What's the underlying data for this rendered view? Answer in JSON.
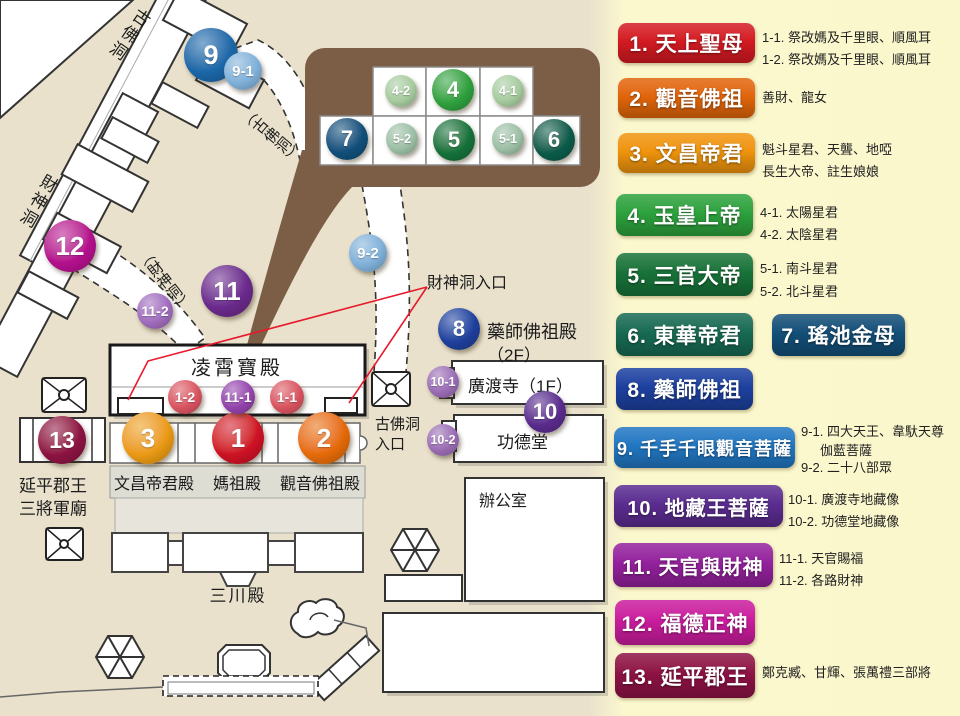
{
  "map": {
    "corridors": {
      "gufodong": "古佛洞",
      "caishendong": "財神洞",
      "gufodong_path": "（古佛洞）",
      "caishendong_path": "（財神洞）"
    },
    "buildings": {
      "lingxiao_hall": "凌霄寶殿",
      "wenchang_hall": "文昌帝君殿",
      "mazu_hall": "媽祖殿",
      "guanyin_hall": "觀音佛祖殿",
      "sanchuan_hall": "三川殿",
      "office": "辦公室",
      "guangdu_temple": "廣渡寺（1F）",
      "gongde_hall": "功德堂",
      "yaoshi_hall_line1": "藥師佛祖殿",
      "yaoshi_hall_line2": "（2F）",
      "yanping_line1": "延平郡王",
      "yanping_line2": "三將軍廟",
      "caishen_entrance": "財神洞入口",
      "gufo_entrance_line1": "古佛洞",
      "gufo_entrance_line2": "入口"
    },
    "markers": {
      "m1": {
        "label": "1",
        "color": "#cf1225"
      },
      "m1_1": {
        "label": "1-1",
        "color": "#d85360"
      },
      "m1_2": {
        "label": "1-2",
        "color": "#d85360"
      },
      "m2": {
        "label": "2",
        "color": "#e66b08"
      },
      "m3": {
        "label": "3",
        "color": "#eb9a14"
      },
      "m4": {
        "label": "4",
        "color": "#2ea03d"
      },
      "m4_1": {
        "label": "4-1",
        "color": "#a6cb9e"
      },
      "m4_2": {
        "label": "4-2",
        "color": "#a6cb9e"
      },
      "m5": {
        "label": "5",
        "color": "#15713a"
      },
      "m5_1": {
        "label": "5-1",
        "color": "#9cbfa5"
      },
      "m5_2": {
        "label": "5-2",
        "color": "#9cbfa5"
      },
      "m6": {
        "label": "6",
        "color": "#0b5b4a"
      },
      "m7": {
        "label": "7",
        "color": "#114f7a"
      },
      "m8": {
        "label": "8",
        "color": "#1f3f9c"
      },
      "m9": {
        "label": "9",
        "color": "#1b67a8"
      },
      "m9_1": {
        "label": "9-1",
        "color": "#7fb0d8"
      },
      "m9_2": {
        "label": "9-2",
        "color": "#7fb0d8"
      },
      "m10": {
        "label": "10",
        "color": "#5a2b8d"
      },
      "m10_1": {
        "label": "10-1",
        "color": "#9a6cb4"
      },
      "m10_2": {
        "label": "10-2",
        "color": "#9a6cb4"
      },
      "m11": {
        "label": "11",
        "color": "#6b2a8c"
      },
      "m11_1": {
        "label": "11-1",
        "color": "#9343ac"
      },
      "m11_2": {
        "label": "11-2",
        "color": "#a06cbd"
      },
      "m12": {
        "label": "12",
        "color": "#b5108e"
      },
      "m13": {
        "label": "13",
        "color": "#8c1342"
      }
    }
  },
  "legend": {
    "items": [
      {
        "name": "1. 天上聖母",
        "color": "#d41a22",
        "notes": [
          "1-1. 祭改媽及千里眼、順風耳",
          "1-2. 祭改媽及千里眼、順風耳"
        ]
      },
      {
        "name": "2. 觀音佛祖",
        "color": "#e2660a",
        "notes": [
          "善財、龍女"
        ]
      },
      {
        "name": "3. 文昌帝君",
        "color": "#f0940c",
        "notes": [
          "魁斗星君、天聾、地啞",
          "長生大帝、註生娘娘"
        ]
      },
      {
        "name": "4. 玉皇上帝",
        "color": "#2da23d",
        "notes": [
          "4-1. 太陽星君",
          "4-2. 太陰星君"
        ]
      },
      {
        "name": "5. 三官大帝",
        "color": "#187339",
        "notes": [
          "5-1. 南斗星君",
          "5-2. 北斗星君"
        ]
      },
      {
        "name": "6. 東華帝君",
        "color": "#176b53",
        "notes": []
      },
      {
        "name": "7. 瑤池金母",
        "color": "#134f78",
        "notes": []
      },
      {
        "name": "8. 藥師佛祖",
        "color": "#1d41a0",
        "notes": []
      },
      {
        "name": "9. 千手千眼觀音菩薩",
        "color": "#2177c2",
        "notes": [
          "9-1. 四大天王、韋馱天尊",
          "伽藍菩薩",
          "9-2. 二十八部眾"
        ]
      },
      {
        "name": "10. 地藏王菩薩",
        "color": "#5b2c90",
        "notes": [
          "10-1. 廣渡寺地藏像",
          "10-2. 功德堂地藏像"
        ]
      },
      {
        "name": "11. 天官與財神",
        "color": "#94219d",
        "notes": [
          "11-1. 天官賜福",
          "11-2. 各路財神"
        ]
      },
      {
        "name": "12. 福德正神",
        "color": "#cb1c9e",
        "notes": []
      },
      {
        "name": "13. 延平郡王",
        "color": "#8e1245",
        "notes": [
          "鄭克臧、甘輝、張萬禮三部將"
        ]
      }
    ]
  }
}
